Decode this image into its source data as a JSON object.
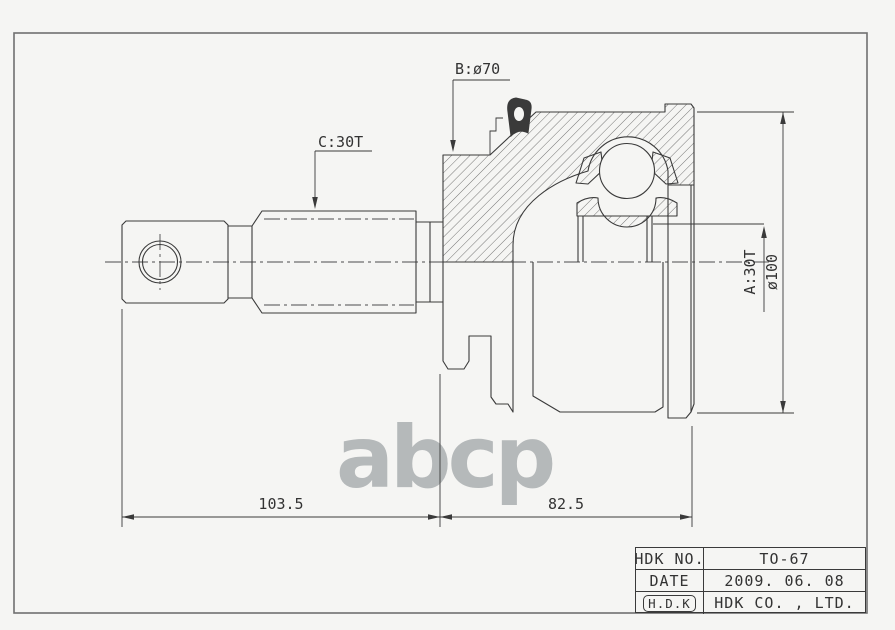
{
  "colors": {
    "bg": "#f5f5f3",
    "line": "#3a3a3a",
    "frame": "#707070",
    "watermark": "#a8acae"
  },
  "watermark_text": "abcp",
  "annotations": {
    "boot_diameter": "B:ø70",
    "outer_spline": "C:30T",
    "inner_spline": "A:30T",
    "outer_diameter": "ø100"
  },
  "dimensions": {
    "shaft_length": "103.5",
    "joint_length": "82.5"
  },
  "title_block": {
    "rows": [
      {
        "label": "HDK NO.",
        "value": "TO-67"
      },
      {
        "label": "DATE",
        "value": "2009. 06. 08"
      },
      {
        "label": "H.D.K",
        "value": "HDK CO. , LTD."
      }
    ]
  }
}
